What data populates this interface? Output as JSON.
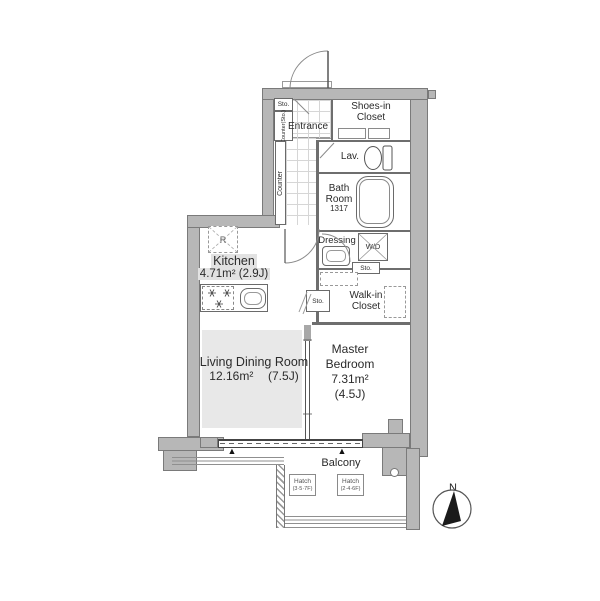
{
  "rooms": {
    "entrance": {
      "label": "Entrance"
    },
    "shoes_closet": {
      "line1": "Shoes-in",
      "line2": "Closet"
    },
    "lav": {
      "label": "Lav."
    },
    "bath": {
      "line1": "Bath",
      "line2": "Room",
      "code": "1317"
    },
    "dressing": {
      "line1": "Dressing",
      "line2": "Room"
    },
    "laundry": {
      "label": "W/D"
    },
    "walk_in_closet": {
      "line1": "Walk-in",
      "line2": "Closet"
    },
    "kitchen": {
      "label": "Kitchen",
      "size": "4.71m² (2.9J)",
      "fridge": "R"
    },
    "living": {
      "label": "Living Dining Room",
      "size": "12.16m²",
      "jyo": "(7.5J)"
    },
    "bedroom": {
      "line1": "Master",
      "line2": "Bedroom",
      "size": "7.31m²",
      "jyo": "(4.5J)"
    },
    "balcony": {
      "label": "Balcony"
    }
  },
  "storage": {
    "entrance_sto": "Sto.",
    "counter_sto": "Counter(Sto.)",
    "counter": "Counter",
    "dressing_sto": "Sto.",
    "hall_sto": "Sto."
  },
  "hatches": [
    {
      "label": "Hatch",
      "floors": "(3·5·7F)"
    },
    {
      "label": "Hatch",
      "floors": "(2·4·6F)"
    }
  ],
  "compass": {
    "label": "N"
  },
  "markers": {
    "vent": "▲"
  },
  "colors": {
    "wall": "#b7b7b7",
    "wall_edge": "#7a7a7a",
    "ldk_floor": "#e8e8e8",
    "label_bg": "#e2e2e2",
    "line": "#555555"
  }
}
